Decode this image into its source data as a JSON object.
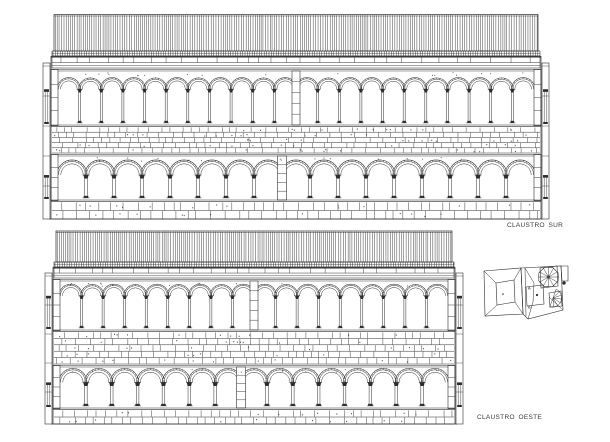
{
  "style": {
    "ink": "#2d2d2d",
    "paper": "#ffffff",
    "label_color": "#3a3a3a"
  },
  "labels": {
    "claustro_sur": {
      "text": "CLAUSTRO SUR"
    },
    "claustro_oeste": {
      "text": "CLAUSTRO OESTE"
    }
  },
  "elevations": [
    {
      "id": "claustro-sur",
      "seed": 7,
      "x": 50,
      "width": 492,
      "roof_top": 14.5,
      "roof_bottom": 51,
      "tile_row_bottom": 56,
      "cornice_bottom": 68,
      "upper": {
        "arches": 22,
        "spring_frac": 0.36,
        "bottom": 127,
        "ticks": 7,
        "shaft": 1.0,
        "cap_w": 4.2,
        "cap_h": 3.2,
        "out": 1.3,
        "archivolt": 2.1,
        "pier_w": 8
      },
      "wall_bottom": 153,
      "wall_courses": 5,
      "lower": {
        "arches": 17,
        "spring_frac": 0.45,
        "bottom": 202,
        "ticks": 9,
        "shaft": 1.3,
        "cap_w": 5.2,
        "cap_h": 3.6,
        "out": 1.5,
        "archivolt": 2.4,
        "pier_w": 9
      },
      "base_bottom": 219,
      "base_courses": 2
    },
    {
      "id": "claustro-oeste",
      "seed": 13,
      "x": 52,
      "width": 404,
      "roof_top": 231,
      "roof_bottom": 262,
      "tile_row_bottom": 267,
      "cornice_bottom": 278,
      "upper": {
        "arches": 18,
        "spring_frac": 0.33,
        "bottom": 332,
        "ticks": 7,
        "shaft": 1.0,
        "cap_w": 4.2,
        "cap_h": 3.2,
        "out": 1.3,
        "archivolt": 2.1,
        "pier_w": 8
      },
      "wall_bottom": 364,
      "wall_courses": 5,
      "lower": {
        "arches": 15,
        "spring_frac": 0.4,
        "bottom": 410,
        "ticks": 9,
        "shaft": 1.3,
        "cap_w": 5.2,
        "cap_h": 3.6,
        "out": 1.5,
        "archivolt": 2.4,
        "pier_w": 9
      },
      "base_bottom": 424,
      "base_courses": 2
    }
  ],
  "key_plan": {
    "polygons": [
      [
        [
          484,
          271
        ],
        [
          521,
          268
        ],
        [
          523,
          314
        ],
        [
          485,
          316
        ]
      ],
      [
        [
          496,
          283
        ],
        [
          514,
          280
        ],
        [
          515,
          302
        ],
        [
          497,
          305
        ]
      ],
      [
        [
          521,
          268
        ],
        [
          561,
          266
        ],
        [
          563,
          310
        ],
        [
          528,
          319
        ],
        [
          523,
          314
        ]
      ],
      [
        [
          540,
          268
        ],
        [
          557,
          266
        ],
        [
          558,
          286
        ],
        [
          541,
          288
        ]
      ],
      [
        [
          526,
          287
        ],
        [
          543,
          285
        ],
        [
          544,
          304
        ],
        [
          527,
          306
        ]
      ],
      [
        [
          549,
          293
        ],
        [
          561,
          291
        ],
        [
          562,
          306
        ],
        [
          550,
          307
        ]
      ],
      [
        [
          561,
          266
        ],
        [
          568,
          266
        ],
        [
          568,
          281
        ],
        [
          562,
          281
        ]
      ]
    ],
    "lines": [
      [
        [
          484,
          271
        ],
        [
          496,
          283
        ]
      ],
      [
        [
          521,
          268
        ],
        [
          514,
          280
        ]
      ],
      [
        [
          523,
          314
        ],
        [
          515,
          302
        ]
      ],
      [
        [
          485,
          316
        ],
        [
          497,
          305
        ]
      ],
      [
        [
          525,
          268
        ],
        [
          534,
          283
        ]
      ],
      [
        [
          534,
          283
        ],
        [
          533,
          302
        ]
      ],
      [
        [
          533,
          302
        ],
        [
          528,
          319
        ]
      ],
      [
        [
          525,
          268
        ],
        [
          526,
          316
        ]
      ],
      [
        [
          563,
          310
        ],
        [
          549,
          297
        ]
      ]
    ],
    "star": {
      "cx": 548.5,
      "cy": 277,
      "r": 10.5,
      "spokes": 12
    },
    "fan": {
      "cx": 553,
      "cy": 298,
      "r": 9.5,
      "start_deg": -70,
      "end_deg": 110,
      "spokes": 7
    },
    "dots": [
      [
        503,
        294,
        0.8
      ],
      [
        537,
        295,
        1.1
      ],
      [
        564,
        283,
        1.7
      ]
    ],
    "markers": [
      [
        528,
        289
      ],
      [
        528,
        308
      ]
    ]
  }
}
